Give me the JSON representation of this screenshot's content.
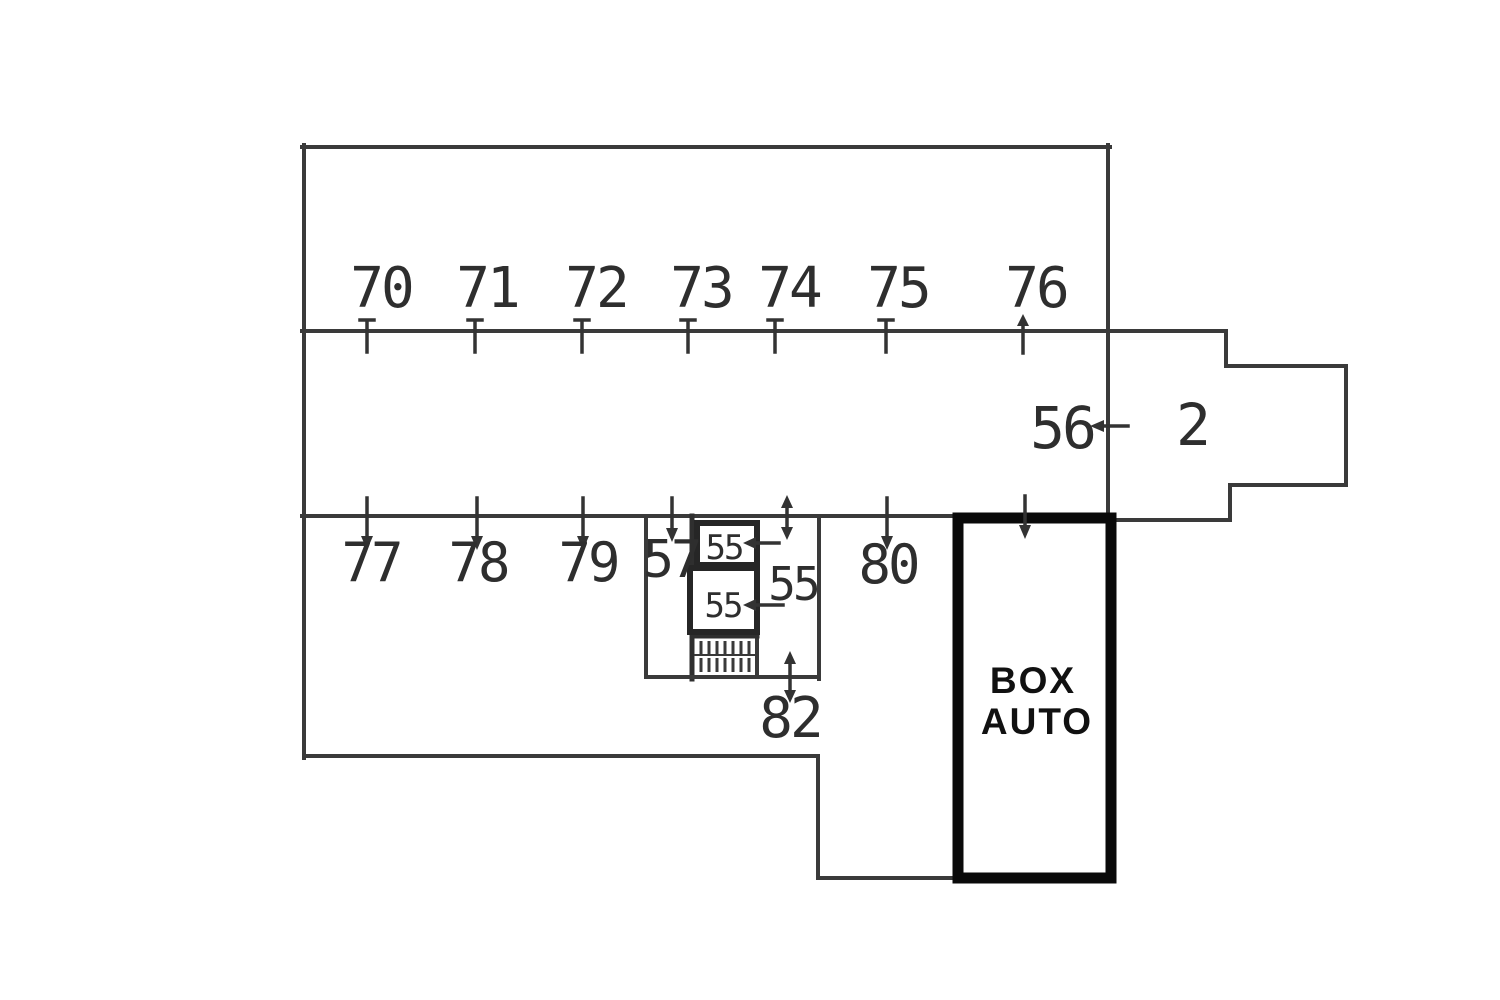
{
  "floorplan": {
    "kind": "garage-parking-floor-plan",
    "spots": {
      "top_row": [
        "70",
        "71",
        "72",
        "73",
        "74",
        "75",
        "76"
      ],
      "middle_right": "56",
      "room_right": "2",
      "bottom_row": [
        "77",
        "78",
        "79"
      ],
      "spot_57": "57",
      "spot_80": "80",
      "storage_box_top": "55",
      "storage_box_bottom": "55",
      "corridor": "55",
      "below_core": "82"
    },
    "box_auto": {
      "line1": "BOX",
      "line2": "AUTO"
    },
    "colors": {
      "background": "#ffffff",
      "line": "#3a3a3a",
      "thick_border": "#0a0a0a",
      "text": "#2e2e2e"
    }
  }
}
